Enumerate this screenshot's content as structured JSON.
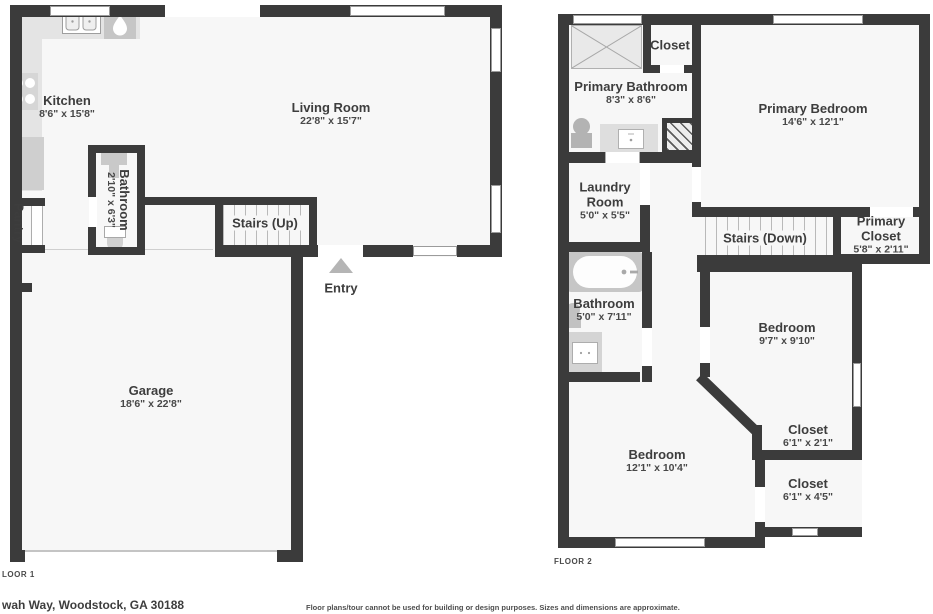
{
  "floor1": {
    "label": "LOOR 1",
    "rooms": {
      "kitchen": {
        "name": "Kitchen",
        "dims": "8'6\" x 15'8\""
      },
      "living": {
        "name": "Living Room",
        "dims": "22'8\" x 15'7\""
      },
      "bathroom": {
        "name": "Bathroom",
        "dims": "2'10\" x 6'3\""
      },
      "pantry": {
        "name": "Pantry"
      },
      "stairs": {
        "name": "Stairs (Up)"
      },
      "entry": {
        "name": "Entry"
      },
      "garage": {
        "name": "Garage",
        "dims": "18'6\" x 22'8\""
      }
    }
  },
  "floor2": {
    "label": "FLOOR 2",
    "rooms": {
      "primary_bathroom": {
        "name": "Primary Bathroom",
        "dims": "8'3\" x 8'6\""
      },
      "closet_top": {
        "name": "Closet"
      },
      "primary_bedroom": {
        "name": "Primary Bedroom",
        "dims": "14'6\" x 12'1\""
      },
      "laundry": {
        "name": "Laundry Room",
        "dims": "5'0\" x 5'5\""
      },
      "stairs": {
        "name": "Stairs (Down)"
      },
      "primary_closet": {
        "name": "Primary Closet",
        "dims": "5'8\" x 2'11\""
      },
      "bathroom": {
        "name": "Bathroom",
        "dims": "5'0\" x 7'11\""
      },
      "bedroom_mid": {
        "name": "Bedroom",
        "dims": "9'7\" x 9'10\""
      },
      "closet_mid": {
        "name": "Closet",
        "dims": "6'1\" x 2'1\""
      },
      "bedroom_bottom": {
        "name": "Bedroom",
        "dims": "12'1\" x 10'4\""
      },
      "closet_bottom": {
        "name": "Closet",
        "dims": "6'1\" x 4'5\""
      }
    }
  },
  "footer": {
    "address": "wah Way, Woodstock, GA 30188",
    "disclaimer": "Floor plans/tour cannot be used for building or design purposes. Sizes and dimensions are approximate."
  },
  "colors": {
    "wall": "#3b3b3b",
    "room_fill": "#f7f7f7",
    "fixture": "#d6d6d6"
  }
}
